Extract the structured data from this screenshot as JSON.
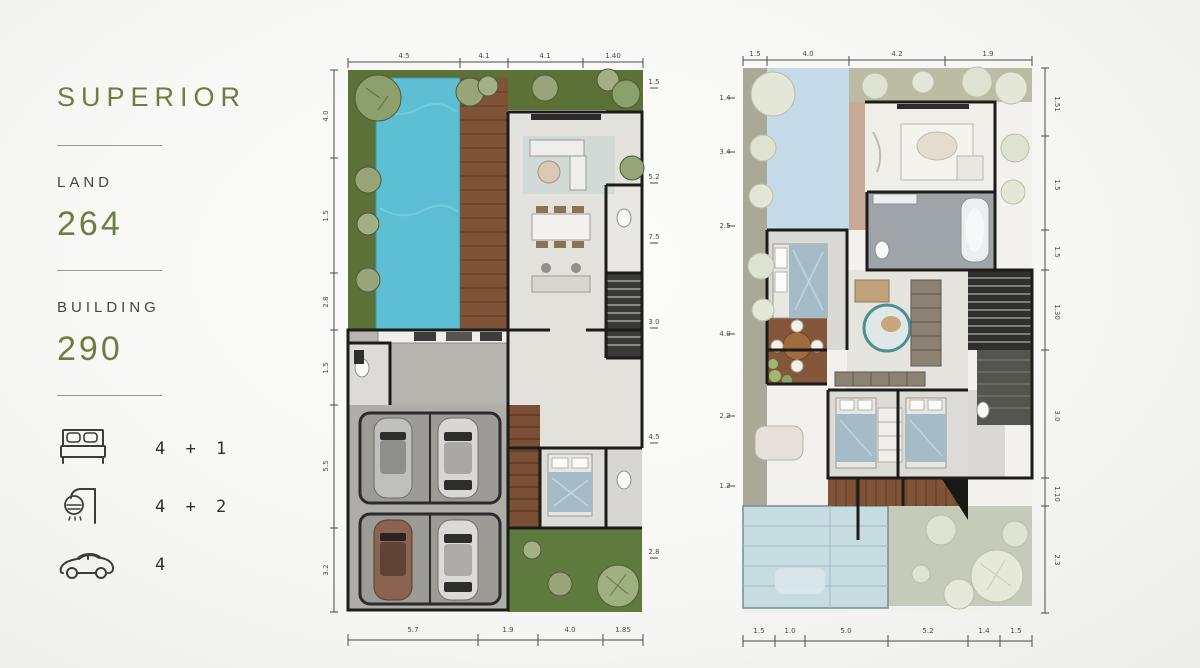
{
  "panel": {
    "title": "SUPERIOR",
    "land": {
      "label": "LAND",
      "value": "264"
    },
    "building": {
      "label": "BUILDING",
      "value": "290"
    },
    "features": [
      {
        "icon": "bed-icon",
        "value": "4 + 1"
      },
      {
        "icon": "shower-icon",
        "value": "4 + 2"
      },
      {
        "icon": "car-icon",
        "value": "4"
      }
    ]
  },
  "palette": {
    "accent_olive": "#6d7e3e",
    "text_dark": "#3c3c3a",
    "pool_blue": "#5dbfd3",
    "deck_wood": "#7e5336",
    "grass_green": "#5b7138",
    "pale_grass": "#c0c0a6",
    "void_blue": "#c6dbe9",
    "canopy_blue": "#c7dce0",
    "floor_light": "#e3e1dc",
    "garage_gray": "#aeada7",
    "wall_black": "#1c1c1a",
    "bed_blue": "#a5bcc8",
    "tree_sage": "#97a578",
    "tree_pale": "#dee2d0"
  },
  "plans": {
    "ground": {
      "name": "ground-floor-plan",
      "dims": {
        "top": [
          "4.5",
          "4.1",
          "4.1",
          "1.40"
        ],
        "bottom": [
          "5.7",
          "1.9",
          "4.0",
          "1.85"
        ],
        "left": [
          "4.0",
          "1.5",
          "2.8",
          "1.5",
          "5.5",
          "3.2"
        ],
        "right": [
          "1.5",
          "5.2",
          "7.5",
          "3.0",
          "4.5",
          "2.8"
        ]
      }
    },
    "upper": {
      "name": "upper-floor-plan",
      "dims": {
        "top": [
          "1.5",
          "4.0",
          "4.2",
          "1.9"
        ],
        "bottom": [
          "1.5",
          "1.0",
          "5.0",
          "5.2",
          "1.4",
          "1.5"
        ],
        "left": [
          "1.4",
          "3.4",
          "2.5",
          "4.0",
          "2.2",
          "1.2"
        ],
        "right": [
          "1.51",
          "1.5",
          "1.5",
          "1.30",
          "3.0",
          "1.10",
          "2.3"
        ]
      }
    }
  }
}
